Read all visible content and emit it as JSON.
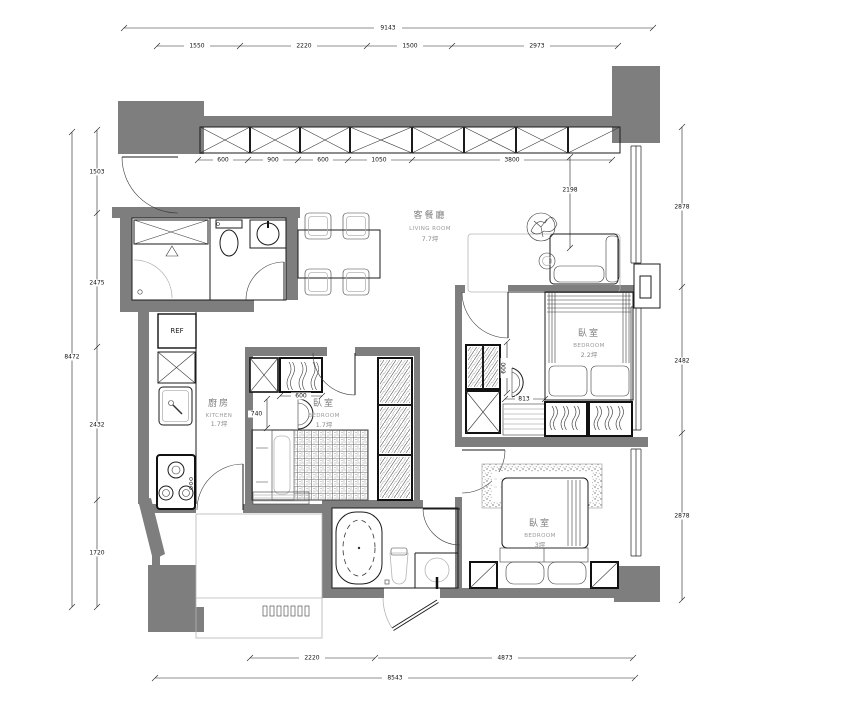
{
  "meta": {
    "type": "apartment-floor-plan"
  },
  "dims": {
    "top": {
      "overall": "9143",
      "segs": [
        "1550",
        "2220",
        "1500",
        "2973"
      ]
    },
    "closet": [
      "600",
      "900",
      "600",
      "1050",
      "3800"
    ],
    "left": {
      "overall": "8472",
      "segs": [
        "1503",
        "2475",
        "2432",
        "1720"
      ]
    },
    "right": {
      "segs": [
        "2878",
        "2482",
        "2878"
      ]
    },
    "bottom": {
      "overall": "8543",
      "segs": [
        "2220",
        "4873"
      ]
    },
    "interior": {
      "living": "2198",
      "b17_closet": "600",
      "b17_depth": "740",
      "b22_depth": "600",
      "b22_width": "813"
    }
  },
  "rooms": {
    "living": {
      "zh": "客餐廳",
      "en": "LIVING ROOM",
      "area": "7.7坪"
    },
    "kitchen": {
      "zh": "廚房",
      "en": "KITCHEN",
      "area": "1.7坪"
    },
    "bedroom_small": {
      "zh": "臥室",
      "en": "BEDROOM",
      "area": "1.7坪"
    },
    "bedroom_mid": {
      "zh": "臥室",
      "en": "BEDROOM",
      "area": "2.2坪"
    },
    "bedroom_master": {
      "zh": "臥室",
      "en": "BEDROOM",
      "area": "3坪"
    }
  },
  "labels": {
    "refrigerator": "REF"
  },
  "colors": {
    "wall": "#7e7e7e",
    "line": "#1b1b1b",
    "light": "#b5b5b5"
  }
}
